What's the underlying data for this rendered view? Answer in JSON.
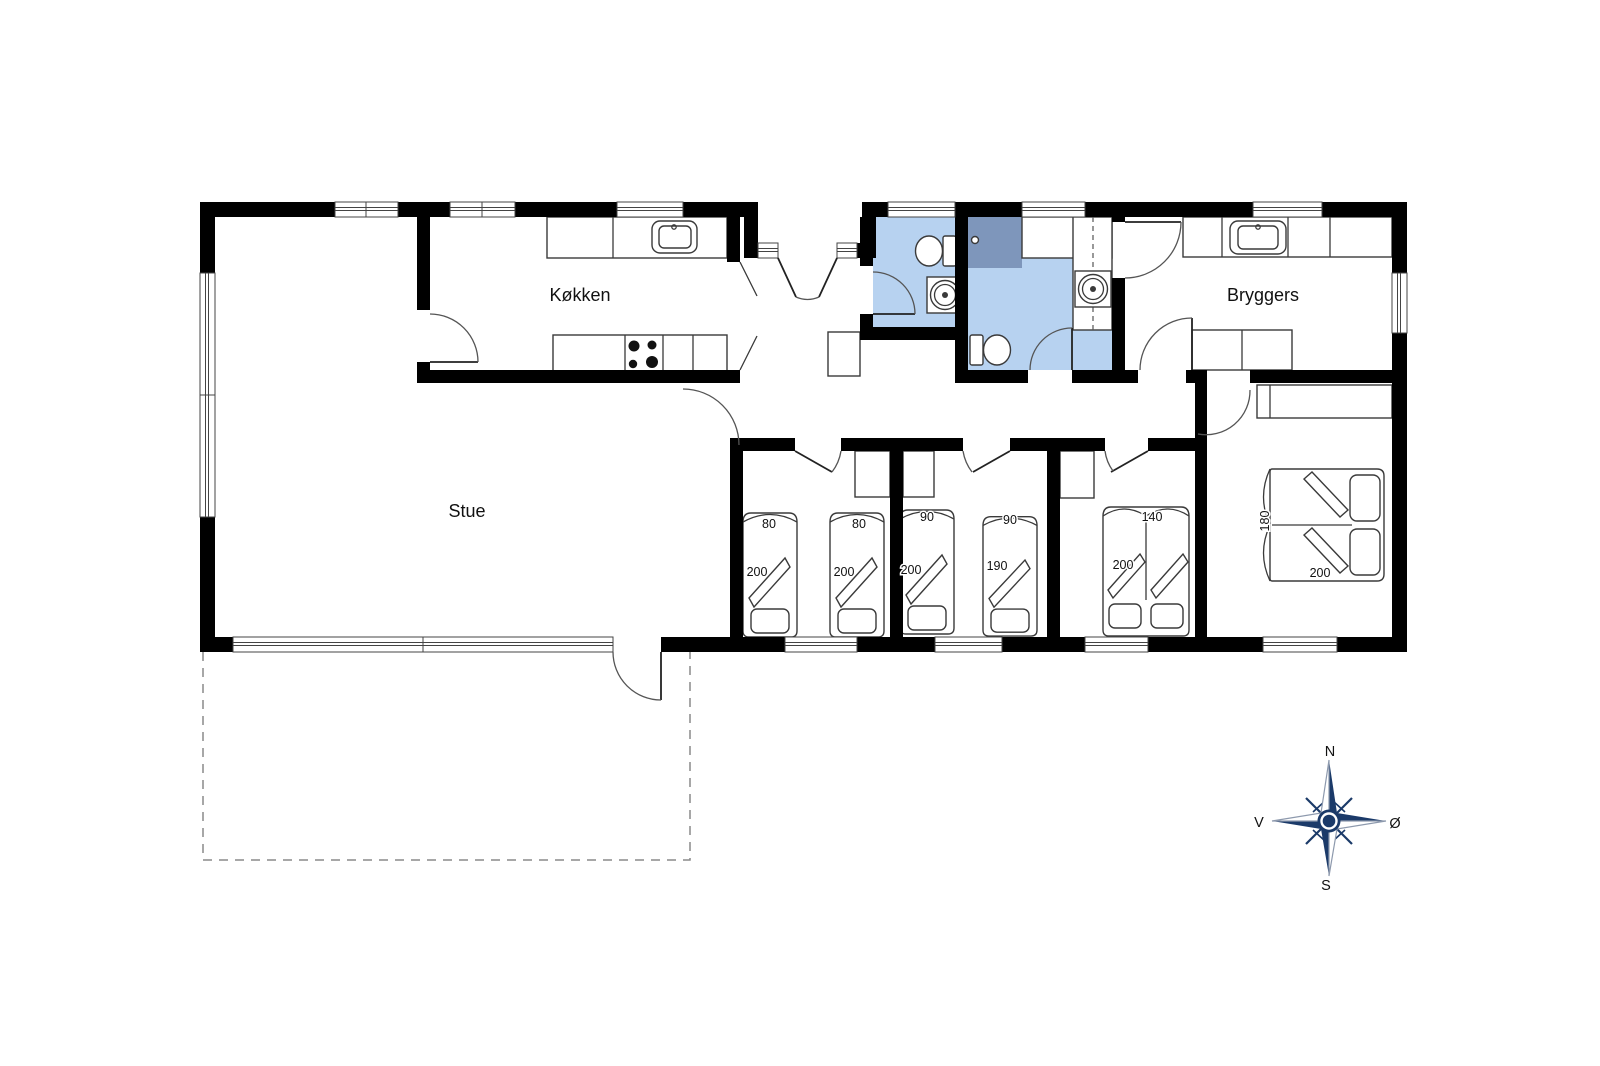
{
  "plan": {
    "rooms": {
      "kitchen": {
        "label": "Køkken"
      },
      "living_room": {
        "label": "Stue"
      },
      "utility": {
        "label": "Bryggers"
      }
    },
    "bedrooms": {
      "bedroom1": {
        "bed1": {
          "width": "80",
          "length": "200"
        },
        "bed2": {
          "width": "80",
          "length": "200"
        }
      },
      "bedroom2": {
        "bed1": {
          "width": "90",
          "length": "200"
        },
        "bed2": {
          "width": "90",
          "length": "190"
        }
      },
      "bedroom3": {
        "bed": {
          "width": "140",
          "length": "200"
        }
      },
      "bedroom4": {
        "bed": {
          "width": "180",
          "length": "200"
        }
      }
    },
    "compass": {
      "north": "N",
      "south": "S",
      "west": "V",
      "east": "Ø"
    },
    "colors": {
      "wall": "#000000",
      "bathroom_floor": "#b7d2f0",
      "shower": "#7e96bb",
      "compass_navy": "#1b3a69"
    }
  }
}
